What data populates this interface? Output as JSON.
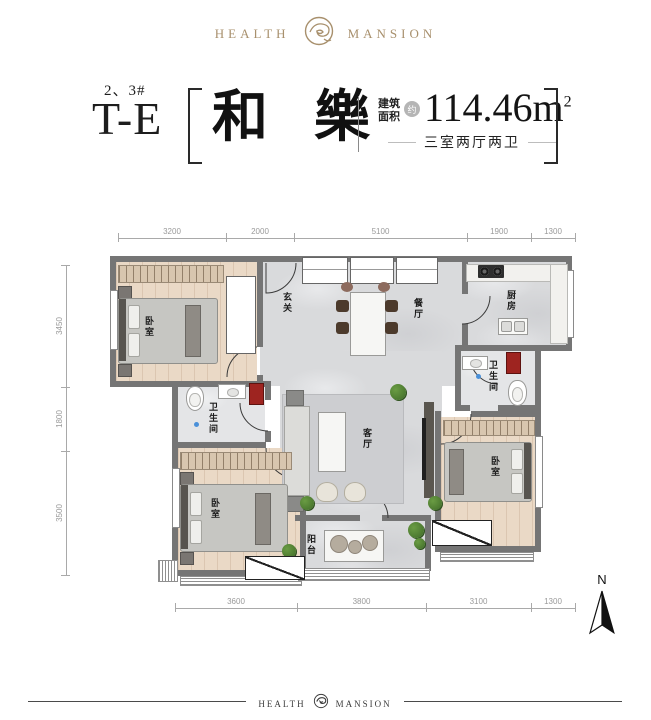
{
  "brand": {
    "left": "HEALTH",
    "right": "MANSION"
  },
  "title": {
    "block": "2、3#",
    "type": "T-E",
    "name": "和 樂",
    "area_label_top": "建筑",
    "area_label_bottom": "面积",
    "approx_badge": "约",
    "area_value": "114.46m",
    "area_sup": "2",
    "layout_desc": "三室两厅两卫"
  },
  "plan": {
    "dims_top": [
      "3200",
      "2000",
      "5100",
      "1900",
      "1300"
    ],
    "dims_left": [
      "3450",
      "1800",
      "3500"
    ],
    "dims_bottom": [
      "3600",
      "3800",
      "3100",
      "1300"
    ],
    "rooms": {
      "bedroom_tl": "卧室",
      "entry": "玄关",
      "dining": "餐厅",
      "kitchen": "厨房",
      "bath_right": "卫生间",
      "bath_left": "卫生间",
      "living": "客厅",
      "bedroom_bl": "卧室",
      "balcony": "阳台",
      "bedroom_br": "卧室"
    }
  },
  "compass": {
    "label": "N"
  },
  "footer": {
    "left": "HEALTH",
    "right": "MANSION"
  },
  "colors": {
    "gold": "#a8906d",
    "wall_gray": "#757575",
    "accent_red": "#9e2420",
    "wood": "#ead9c6",
    "marble": "#d9dadc",
    "plant_green": "#4e7d33"
  }
}
